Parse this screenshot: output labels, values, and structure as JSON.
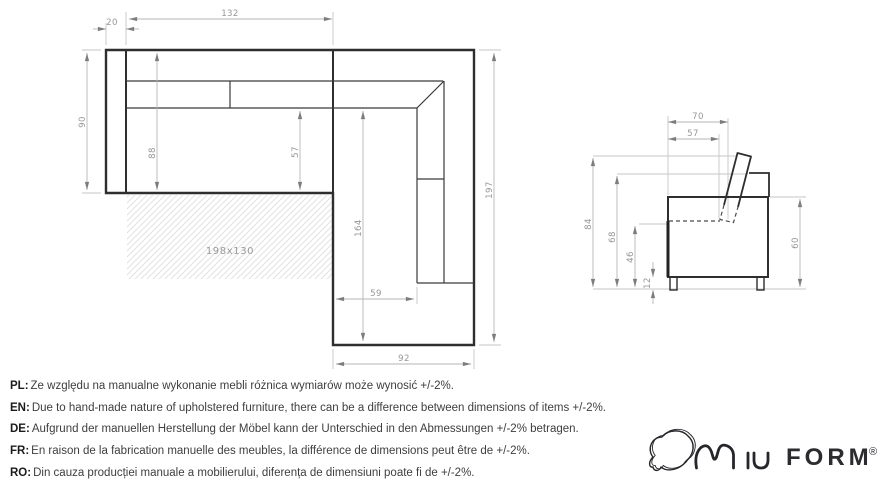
{
  "top_view": {
    "dims": {
      "arm_width": "20",
      "section_width": "132",
      "depth": "90",
      "inner_depth": "88",
      "seat_depth": "57",
      "chaise_inner_length": "164",
      "total_length": "197",
      "corner_seat_width": "59",
      "chaise_width": "92",
      "sleeping_area": "198x130"
    }
  },
  "side_view": {
    "dims": {
      "backrest_top_width": "70",
      "cushion_depth": "57",
      "total_height": "84",
      "back_height": "68",
      "seat_height": "46",
      "leg_height": "12",
      "side_height": "60"
    }
  },
  "disclaimers": [
    {
      "label": "PL:",
      "text": "Ze względu na manualne wykonanie mebli różnica wymiarów może wynosić +/-2%."
    },
    {
      "label": "EN:",
      "text": "Due to hand-made nature of upholstered furniture, there can be a difference between dimensions of items +/-2%."
    },
    {
      "label": "DE:",
      "text": "Aufgrund der manuellen Herstellung der Möbel kann der Unterschied in den Abmessungen +/-2% betragen."
    },
    {
      "label": "FR:",
      "text": "En raison de la fabrication manuelle des meubles, la différence de dimensions peut être de +/-2%."
    },
    {
      "label": "RO:",
      "text": "Din cauza producției manuale a mobilierului, diferența de dimensiuni poate fi de +/-2%."
    }
  ],
  "logo": {
    "brand_script": "MIU",
    "brand_bold": "FORM",
    "registered": "®"
  }
}
